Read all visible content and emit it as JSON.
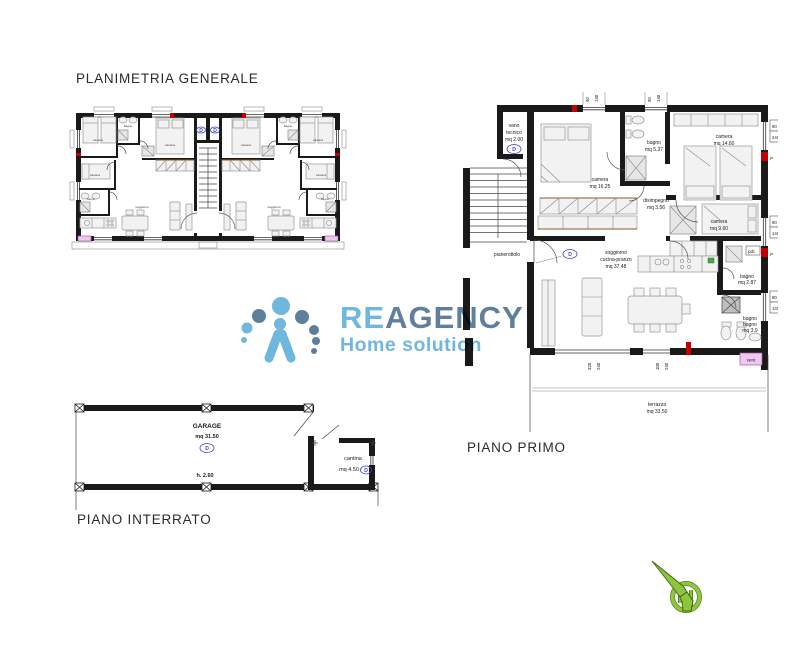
{
  "titles": {
    "general": "PLANIMETRIA GENERALE",
    "first": "PIANO PRIMO",
    "basement": "PIANO INTERRATO"
  },
  "logo": {
    "brand_a": "RE",
    "brand_b": "AGENCY",
    "tagline": "Home solution",
    "color_light": "#6fb7dd",
    "color_dark": "#5f7f9d"
  },
  "general_plan": {
    "badge": "D",
    "labels": {
      "camera1": "camera",
      "bagno1": "bagno",
      "camera2": "camera",
      "camera3": "camera",
      "bagno2": "bagno",
      "soggiorno": "soggiorno"
    }
  },
  "piano_primo": {
    "vano": {
      "l1": "vano",
      "l2": "tecnico",
      "l3": "mq 2.00"
    },
    "camera1": {
      "l1": "camera",
      "l2": "mq 16.25"
    },
    "bagno1": {
      "l1": "bagno",
      "l2": "mq 5.37"
    },
    "camera2": {
      "l1": "camera",
      "l2": "mq 14.60"
    },
    "disimpegno": {
      "l1": "disimpegno",
      "l2": "mq 3.56"
    },
    "camera3": {
      "l1": "camera",
      "l2": "mq 9.60"
    },
    "soggiorno": {
      "l1": "soggiorno",
      "l2": "cucina-pranzo",
      "l3": "mq 37.48"
    },
    "bagno2": {
      "l1": "bagno",
      "l2": "mq 2.87"
    },
    "bagno3": {
      "l1": "bagno",
      "l2": "bagno",
      "l3": "mq 3.9"
    },
    "pianerottolo": "pianerottolo",
    "terrazza": {
      "l1": "terrazza",
      "l2": "mq 33.50"
    },
    "badge": "D",
    "pdc": "pdc",
    "vent": "vent",
    "p": "P",
    "dims": {
      "top1a": "90",
      "top1b": "140",
      "top2a": "90",
      "top2b": "140",
      "right1a": "90",
      "right1b": "240",
      "right2a": "90",
      "right2b": "140",
      "right3a": "80",
      "right3b": "140",
      "bottom1a": "320",
      "bottom1b": "240",
      "bottom2a": "100",
      "bottom2b": "240"
    }
  },
  "piano_interrato": {
    "garage": {
      "l1": "GARAGE",
      "l2": "mq 31.50",
      "h": "h. 2.60"
    },
    "cantina": {
      "l1": "cantina",
      "l2": "mq 4.50"
    },
    "badge": "D"
  }
}
